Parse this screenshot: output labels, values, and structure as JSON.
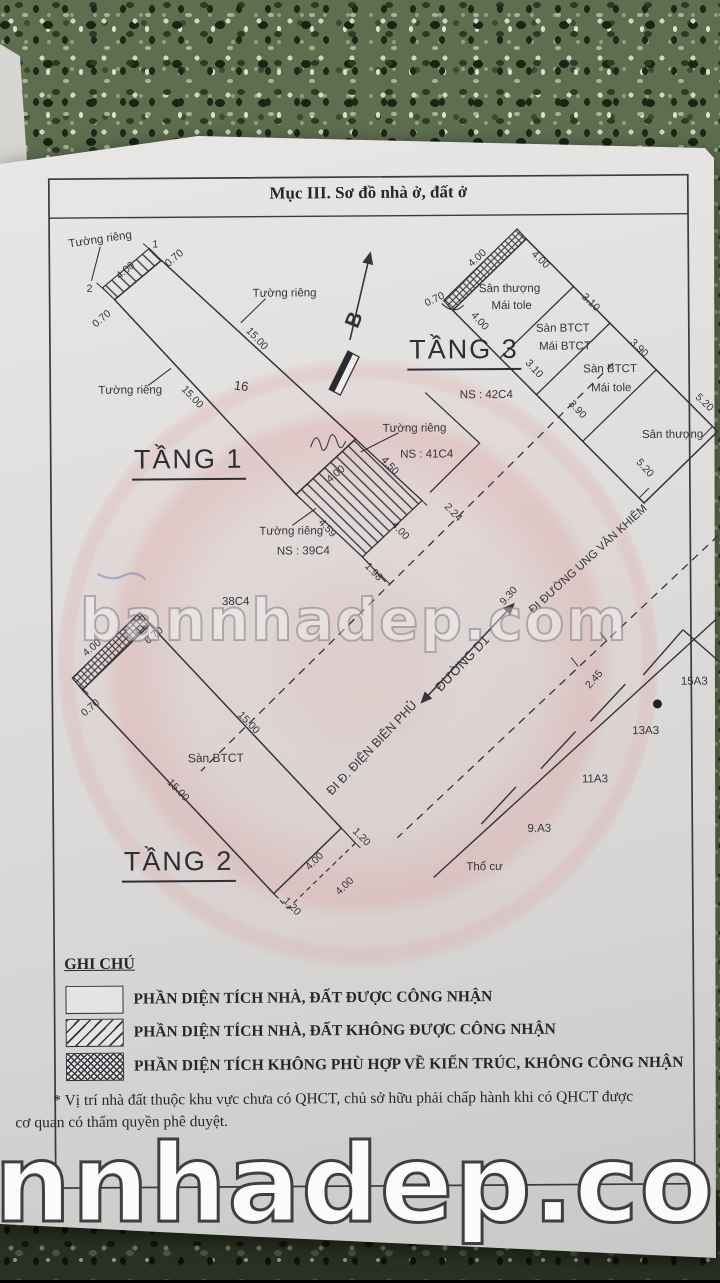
{
  "title": "Mục III. Sơ đồ nhà ở, đất ở",
  "compass": {
    "north": "B"
  },
  "common": {
    "wall": "Tường riêng"
  },
  "tang1": {
    "name": "TẦNG 1",
    "no": "16",
    "p1": "1",
    "p2": "2",
    "dims": {
      "w400": "4.00",
      "t070a": "0.70",
      "t070b": "0.70",
      "len_a": "15.00",
      "len_b": "15.00",
      "h400a": "4.00",
      "h450": "4.50",
      "h459": "4.59",
      "h400b": "4.00",
      "d224": "2.24",
      "d198": "1.98"
    }
  },
  "tang2": {
    "name": "TẦNG 2",
    "floor": "Sàn BTCT",
    "dims": {
      "w400": "4.00",
      "t070a": "0.70",
      "t070b": "0.70",
      "len_a": "15.00",
      "len_b": "15.00",
      "e400": "4.00",
      "e120a": "1.20",
      "e400d": "4.00",
      "e120b": "1.20"
    }
  },
  "tang3": {
    "name": "TẦNG 3",
    "cells": [
      {
        "l1": "Sân thượng",
        "l2": "Mái tole"
      },
      {
        "l1": "Sàn BTCT",
        "l2": "Mái BTCT"
      },
      {
        "l1": "Sàn BTCT",
        "l2": "Mái tole"
      },
      {
        "l1": "Sân thượng",
        "l2": ""
      }
    ],
    "dims": {
      "a400": "4.00",
      "b400": "4.00",
      "t070": "0.70",
      "c400": "4.00",
      "a310": "3.10",
      "b310": "3.10",
      "a390": "3.90",
      "b390": "3.90",
      "a520": "5.20",
      "b520": "5.20"
    }
  },
  "neighbors": {
    "ns39": "NS : 39C4",
    "ns41": "NS : 41C4",
    "ns42": "NS : 42C4",
    "c38": "38C4"
  },
  "roads": {
    "street": "ĐƯỜNG D1",
    "to_dbp": "ĐI Đ. ĐIỆN BIÊN PHỦ",
    "to_uvk": "ĐI ĐƯỜNG UNG VĂN KHIÊM",
    "d930": "9.30",
    "d245": "2.45"
  },
  "lots": {
    "l15": "15A3",
    "l13": "13A3",
    "l11": "11A3",
    "l9": "9.A3",
    "tho_cu": "Thổ cư"
  },
  "legend": {
    "heading": "GHI CHÚ",
    "items": [
      {
        "label": "PHẦN DIỆN TÍCH NHÀ, ĐẤT ĐƯỢC CÔNG NHẬN",
        "pattern": "none"
      },
      {
        "label": "PHẦN DIỆN TÍCH NHÀ, ĐẤT KHÔNG ĐƯỢC CÔNG NHẬN",
        "pattern": "diagonal"
      },
      {
        "label": "PHẦN DIỆN TÍCH KHÔNG PHÙ HỢP VỀ KIẾN TRÚC, KHÔNG CÔNG NHẬN",
        "pattern": "crosshatch"
      }
    ]
  },
  "note": {
    "line1": "* Vị trí nhà đất thuộc khu vực chưa có QHCT, chủ sở hữu phải chấp hành khi có QHCT được",
    "line2": "cơ quan có thẩm quyền phê duyệt."
  },
  "watermarks": {
    "middle": "bannhadep.com",
    "bottom": "nnhadep.com"
  },
  "colors": {
    "ink": "#34343c",
    "paper": "#e3e1df",
    "emblem_pink": "#e0a8a8",
    "floor_green": "#5e6f4f"
  }
}
